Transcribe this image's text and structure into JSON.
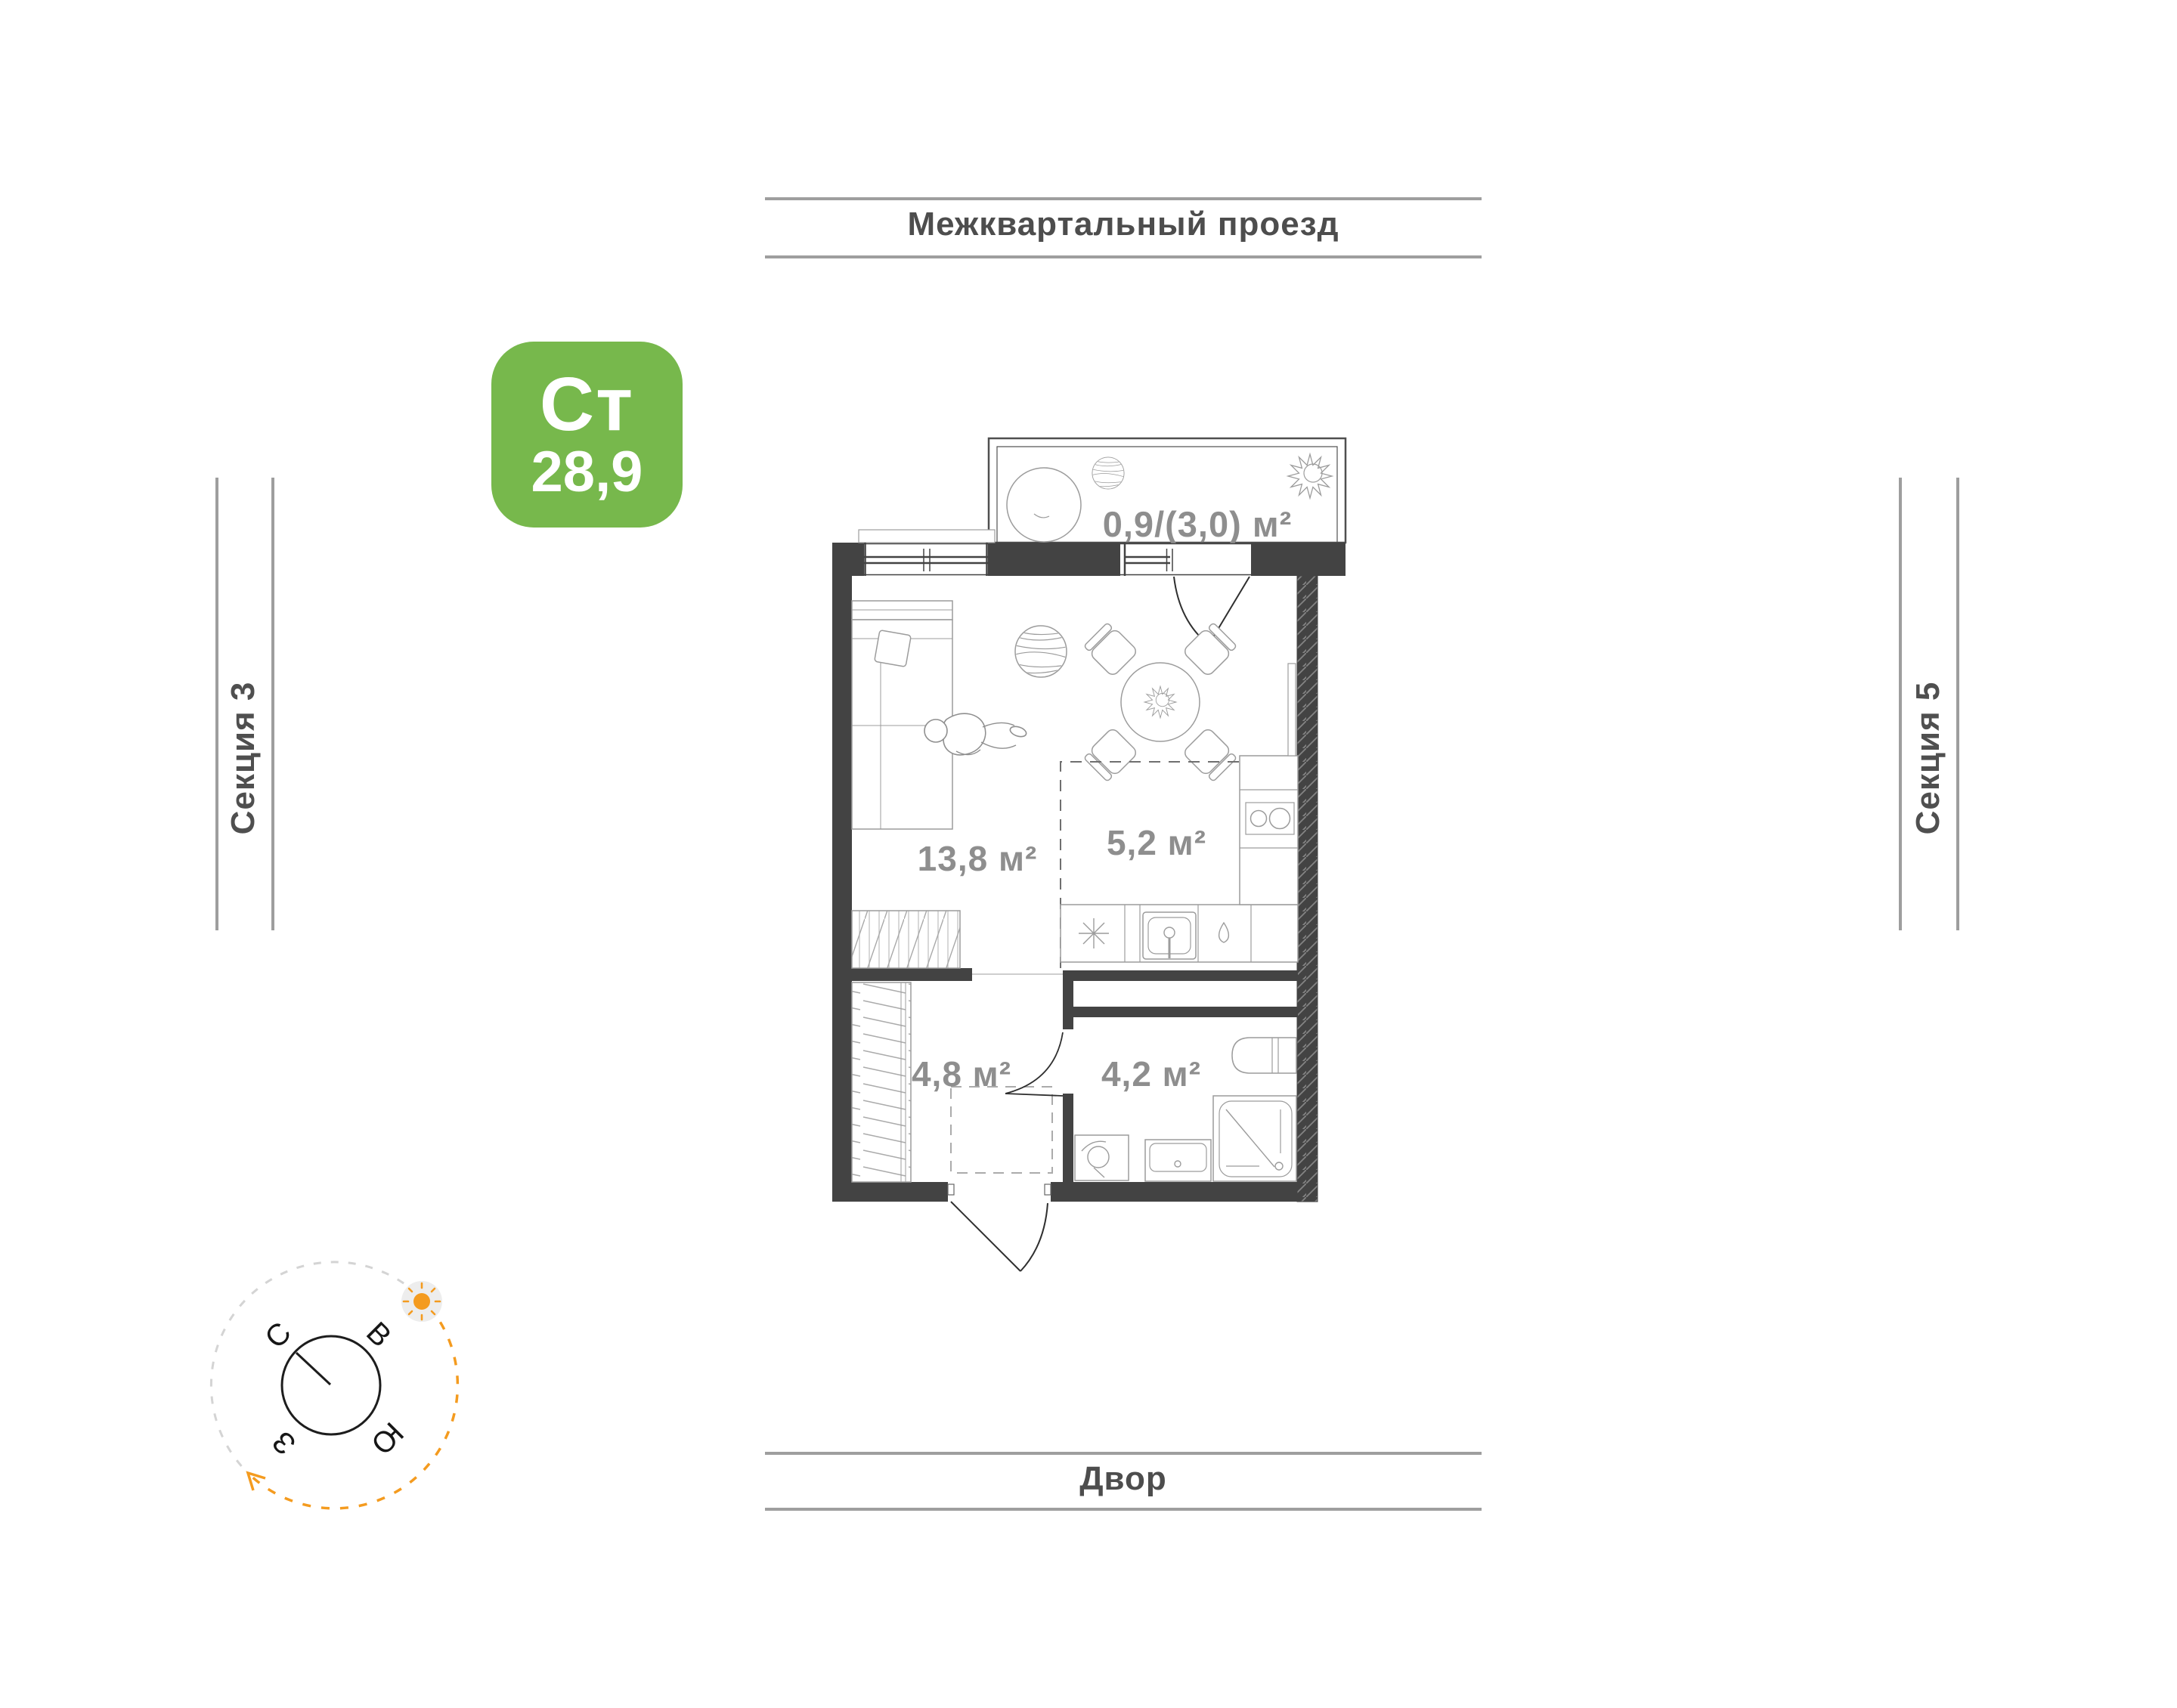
{
  "badge": {
    "label": "Ст",
    "area": "28,9"
  },
  "surroundings": {
    "top": "Межквартальный проезд",
    "bottom": "Двор",
    "left": "Секция 3",
    "right": "Секция 5"
  },
  "plan": {
    "balcony": {
      "area": "0,9/(3,0) м²"
    },
    "rooms": [
      {
        "name": "living-room",
        "area": "13,8 м²"
      },
      {
        "name": "kitchen",
        "area": "5,2 м²"
      },
      {
        "name": "hallway",
        "area": "4,8 м²"
      },
      {
        "name": "bathroom",
        "area": "4,2 м²"
      }
    ]
  },
  "compass": {
    "north": "С",
    "east": "В",
    "south": "Ю",
    "west": "З"
  },
  "icons": {
    "sun": "sun-icon",
    "plant": "plant-icon",
    "compass": "compass-rose-icon"
  },
  "colors": {
    "badge_green": "#77B84C",
    "accent_orange": "#F49B1F",
    "wall": "#434343",
    "area_text": "#8E8E8E",
    "label_text": "#4D4D4D",
    "guide_line": "#9E9E9E"
  }
}
